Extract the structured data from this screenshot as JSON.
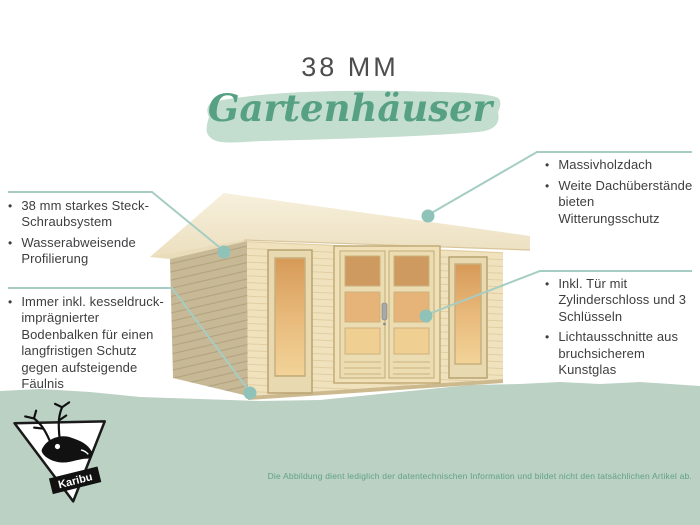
{
  "header": {
    "size_label": "38 MM",
    "category_script": "Gartenhäuser"
  },
  "callouts": {
    "left_top": {
      "items": [
        "38 mm starkes Steck-Schraubsystem",
        "Wasserabweisende Profilierung"
      ]
    },
    "left_bottom": {
      "items": [
        "Immer inkl. kesseldruck-imprägnierter Bodenbalken für einen langfristigen Schutz gegen aufsteigende Fäulnis"
      ]
    },
    "right_top": {
      "items": [
        "Massivholzdach",
        "Weite Dachüberstände bieten Witterungsschutz"
      ]
    },
    "right_bottom": {
      "items": [
        "Inkl. Tür mit Zylinderschloss und 3 Schlüsseln",
        "Lichtausschnitte aus bruchsicherem Kunstglas"
      ]
    }
  },
  "bullet_char": "•",
  "logo": {
    "brand": "Karibu"
  },
  "footer": {
    "disclaimer": "Die Abbildung dient lediglich der datentechnischen Information und bildet nicht den tatsächlichen Artikel ab."
  },
  "illustration": {
    "subject": "wooden flat-roof garden house with double door and two windows"
  },
  "colors": {
    "accent_dot": "#8fc2b8",
    "connector": "#a5cdc3",
    "script_green": "#56a083",
    "brush_green": "#c3ddce",
    "band_green": "#bad1c4",
    "text_dark": "#3e3e40",
    "disclaimer_green": "#63a186"
  }
}
